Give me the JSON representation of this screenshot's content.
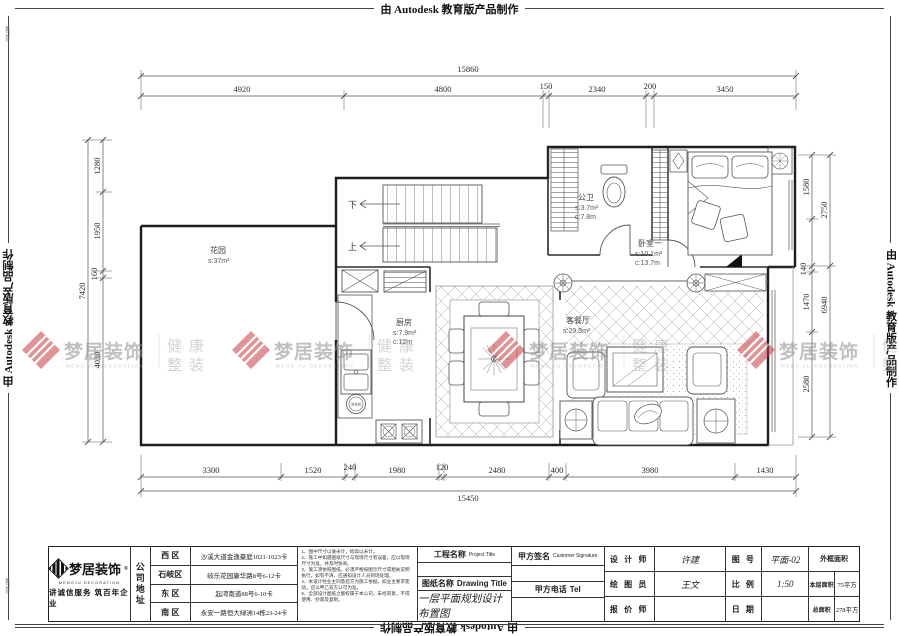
{
  "banner": {
    "text": "由 Autodesk 教育版产品制作"
  },
  "page_mark": "第21页",
  "colors": {
    "watermark_red": "#c73c42",
    "wall": "#1c1c1c",
    "dim_line": "#555555"
  },
  "watermark": {
    "brand": "梦居装饰",
    "brand_en": "MENG JU DECORATION",
    "slogan_line1": "健康",
    "slogan_line2": "整装"
  },
  "dims": {
    "top": {
      "total": "15860",
      "segments": [
        "4920",
        "4800",
        "150",
        "2340",
        "200",
        "3450"
      ]
    },
    "bottom": {
      "total": "15450",
      "segments": [
        "3300",
        "1520",
        "240",
        "1980",
        "120",
        "2480",
        "400",
        "3980",
        "1430"
      ]
    },
    "left": {
      "total": "7420",
      "segments": [
        "1280",
        "1950",
        "160",
        "4030"
      ]
    },
    "right": {
      "inner": [
        "1580",
        "140",
        "1470",
        "2580"
      ],
      "outer": [
        "2750",
        "6940"
      ]
    }
  },
  "rooms": {
    "garden": {
      "name": "花园",
      "area": "s:37m²"
    },
    "kitchen": {
      "name": "厨房",
      "area": "s:7.9m²",
      "perimeter": "c:12m"
    },
    "bath": {
      "name": "公卫",
      "area": "s:3.7m²",
      "perimeter": "c:7.8m"
    },
    "bedroom": {
      "name": "卧室一",
      "area": "s:10.1m²",
      "perimeter": "c:13.7m"
    },
    "living": {
      "name": "客餐厅",
      "area": "s:29.5m²"
    },
    "stairs_up": "上",
    "stairs_down": "下",
    "washer": "洗衣机"
  },
  "title_block": {
    "logo": {
      "brand": "梦居装饰",
      "reg": "®",
      "brand_en": "MENGJU DECORATION",
      "slogan": "讲诚信服务 筑百年企业"
    },
    "company_address_label": "公司地址",
    "addresses": [
      {
        "district": "西 区",
        "address": "沙溪大道金逸豪庭1021-1023卡"
      },
      {
        "district": "石岐区",
        "address": "岐乐花园康华路8号6-12卡"
      },
      {
        "district": "东 区",
        "address": "起湾南道88号6-10卡"
      },
      {
        "district": "南 区",
        "address": "永安一路恒大绿洲14栋23-24卡"
      }
    ],
    "notes": [
      "1、图中尺寸以毫米计，标高以米计。",
      "2、施工中如遇图纸尺寸与现场尺寸有误差，应以现场尺寸为准，并及时协商。",
      "3、施工须依照图纸，必须严格按图示尺寸或相关说明执行，如有不清，应通知设计人员到场处理。",
      "4、本设计经业主同意后方为施工依据，如业主要求变动，应以甲乙双方认可为准。",
      "5、全部设计图纸之版权属于本公司，未经同意，不得使用、抄袭及复制。"
    ],
    "project_title_label": "工程名称",
    "project_title_en": "Project Title",
    "drawing_title_label": "图纸名称",
    "drawing_title_en": "Drawing Title",
    "drawing_title": "一层平面规划设计布置图",
    "customer_sign_label": "甲方签名",
    "customer_sign_en": "Customer Signature",
    "customer_tel_label": "甲方电话",
    "customer_tel_en": "Tel",
    "designer_label": "设 计 师",
    "designer": "许建",
    "draftsman_label": "绘 图 员",
    "draftsman": "王文",
    "estimator_label": "报 价 师",
    "estimator": "",
    "sheet_no_label": "图 号",
    "sheet_no": "平面-02",
    "scale_label": "比 例",
    "scale": "1:50",
    "date_label": "日 期",
    "date": "",
    "area_header": "外框面积",
    "floor_area_label": "本层面积",
    "floor_area": "75平方",
    "total_area_label": "总面积",
    "total_area": "278平方"
  }
}
